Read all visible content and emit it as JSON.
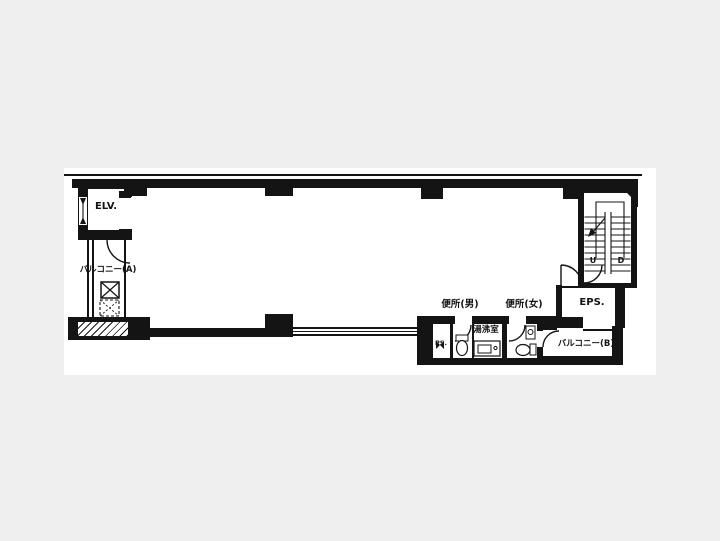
{
  "colors": {
    "background": "#efefef",
    "paper": "#ffffff",
    "ink": "#141414"
  },
  "plan": {
    "type": "building-floor-plan",
    "labels": {
      "elevator": "ELV.",
      "balcony_a": "バルコニー(A)",
      "balcony_b": "バルコニー(B)",
      "toilet_men": "便所(男)",
      "toilet_women": "便所(女)",
      "kitchenette": "湯沸室",
      "eps": "EPS.",
      "pipe_space": "PS.",
      "stair_up": "U",
      "stair_down": "D"
    }
  }
}
